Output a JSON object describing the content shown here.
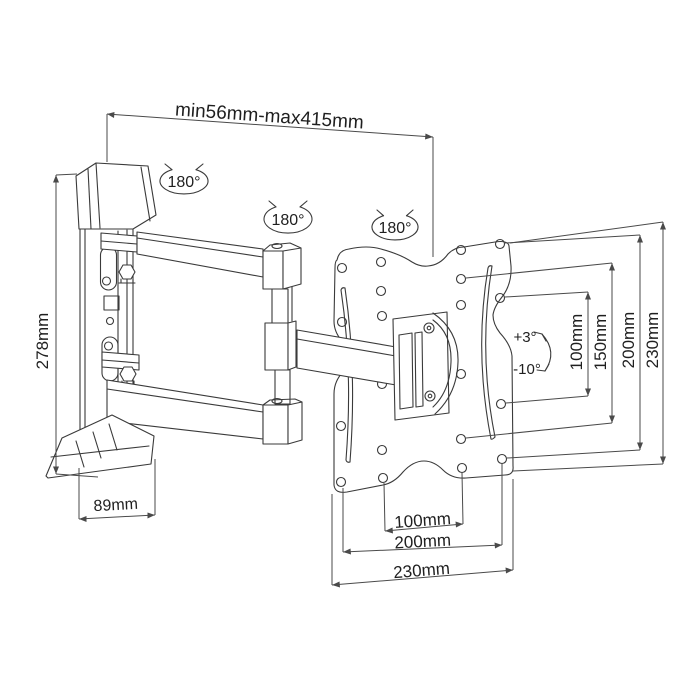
{
  "labels": {
    "extension_range": "min56mm-max415mm",
    "swivel": [
      "180°",
      "180°",
      "180°"
    ],
    "bracket_height": "278mm",
    "bracket_depth": "89mm",
    "tilt_up": "+3°",
    "tilt_down": "-10°",
    "vesa_vertical": [
      "100mm",
      "150mm",
      "200mm",
      "230mm"
    ],
    "plate_horizontal": [
      "100mm",
      "200mm",
      "230mm"
    ]
  },
  "colors": {
    "line": "#3a3a3a",
    "text": "#1f1f1f",
    "background": "#ffffff"
  }
}
